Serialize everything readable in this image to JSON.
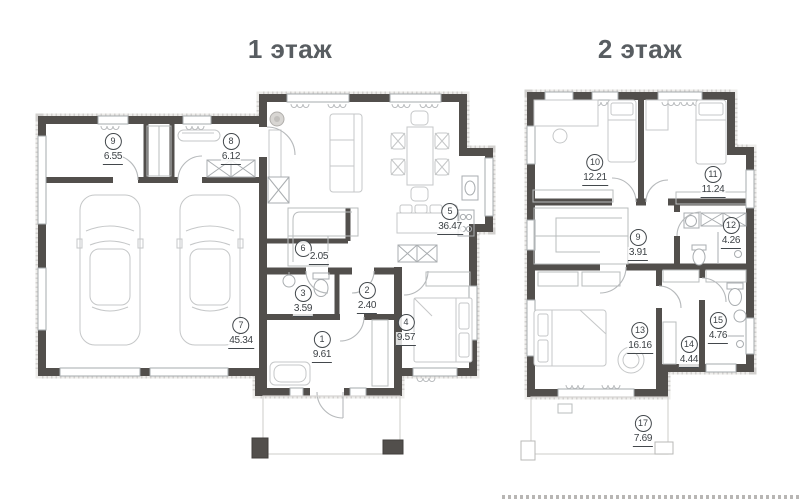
{
  "floors": [
    {
      "title": "1 этаж",
      "rooms": [
        {
          "number": "1",
          "area": "9.61"
        },
        {
          "number": "2",
          "area": "2.40"
        },
        {
          "number": "3",
          "area": "3.59"
        },
        {
          "number": "4",
          "area": "9.57"
        },
        {
          "number": "5",
          "area": "36.47"
        },
        {
          "number": "6",
          "area": "2.05"
        },
        {
          "number": "7",
          "area": "45.34"
        },
        {
          "number": "8",
          "area": "6.12"
        },
        {
          "number": "9",
          "area": "6.55"
        }
      ]
    },
    {
      "title": "2 этаж",
      "rooms": [
        {
          "number": "9",
          "area": "3.91"
        },
        {
          "number": "10",
          "area": "12.21"
        },
        {
          "number": "11",
          "area": "11.24"
        },
        {
          "number": "12",
          "area": "4.26"
        },
        {
          "number": "13",
          "area": "16.16"
        },
        {
          "number": "14",
          "area": "4.44"
        },
        {
          "number": "15",
          "area": "4.76"
        },
        {
          "number": "17",
          "area": "7.69"
        }
      ]
    }
  ],
  "colors": {
    "wall": "#524f4c",
    "title_text": "#585d61",
    "label_text": "#3c4145"
  }
}
